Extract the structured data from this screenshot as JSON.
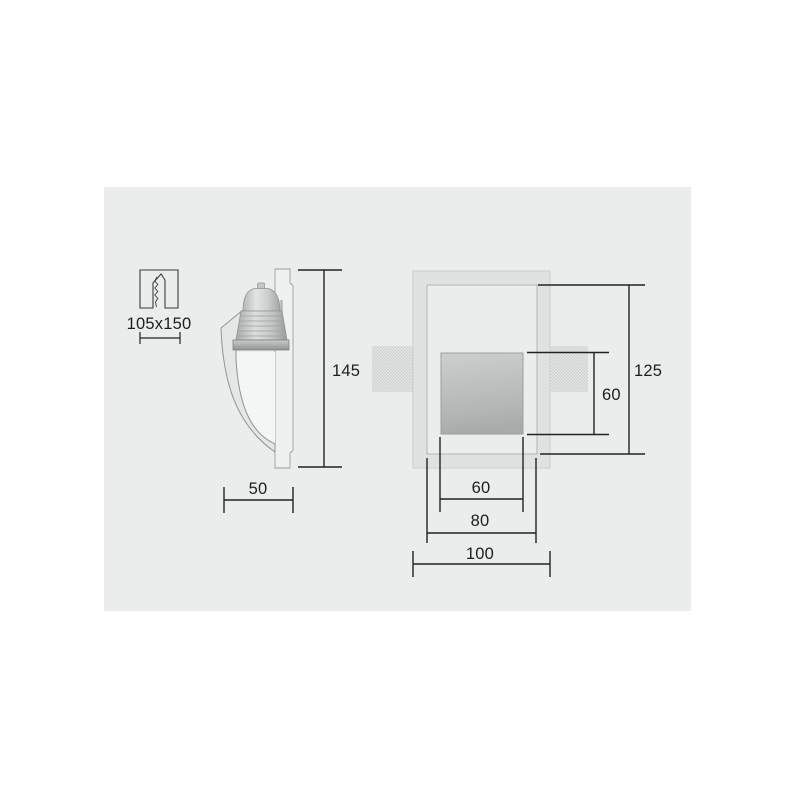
{
  "colors": {
    "page_bg": "#ffffff",
    "panel_bg": "#eaedec",
    "dimension_line": "#222222",
    "frame_fill": "#dfe2e1",
    "aperture_gradient_top": "#cbcfce",
    "aperture_gradient_bottom": "#a7acab"
  },
  "icons": {
    "cutout_icon": "wall-cutout-icon"
  },
  "cutout": {
    "label": "105x150"
  },
  "side_view": {
    "height": "145",
    "depth": "50"
  },
  "front_view": {
    "opening_height": "125",
    "lamp_recess_height": "60",
    "lamp_recess_width": "60",
    "opening_width": "80",
    "frame_width": "100"
  }
}
